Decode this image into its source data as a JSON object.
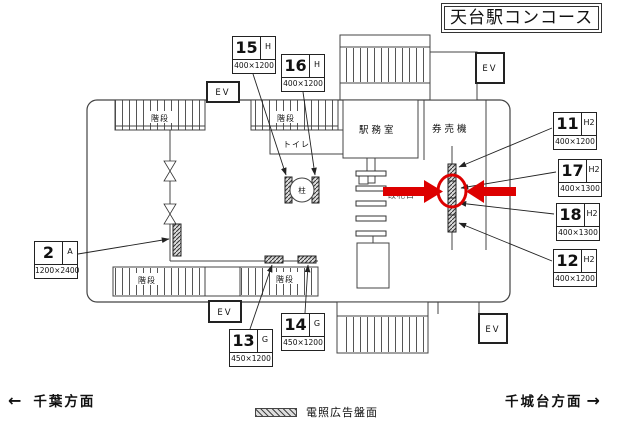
{
  "title": "天台駅コンコース",
  "legend": {
    "label": "電照広告盤面"
  },
  "directions": {
    "left": {
      "arrow": "←",
      "label": "千葉方面"
    },
    "right": {
      "label": "千城台方面",
      "arrow": "→"
    }
  },
  "map": {
    "station_office": "駅務室",
    "ticket_machines": "券売機",
    "ticket_gate": "改札口",
    "toilet": "トイレ",
    "pillar": "柱",
    "stairs": "階段",
    "elevator": "EV"
  },
  "boards": {
    "b2": {
      "num": "2",
      "code": "A",
      "size": "1200×2400"
    },
    "b11": {
      "num": "11",
      "code": "H2",
      "size": "400×1200"
    },
    "b12": {
      "num": "12",
      "code": "H2",
      "size": "400×1200"
    },
    "b13": {
      "num": "13",
      "code": "G",
      "size": "450×1200"
    },
    "b14": {
      "num": "14",
      "code": "G",
      "size": "450×1200"
    },
    "b15": {
      "num": "15",
      "code": "H",
      "size": "400×1200"
    },
    "b16": {
      "num": "16",
      "code": "H",
      "size": "400×1200"
    },
    "b17": {
      "num": "17",
      "code": "H2",
      "size": "400×1300"
    },
    "b18": {
      "num": "18",
      "code": "H2",
      "size": "400×1300"
    }
  },
  "colors": {
    "highlight": "#dd0000",
    "line": "#444444"
  }
}
